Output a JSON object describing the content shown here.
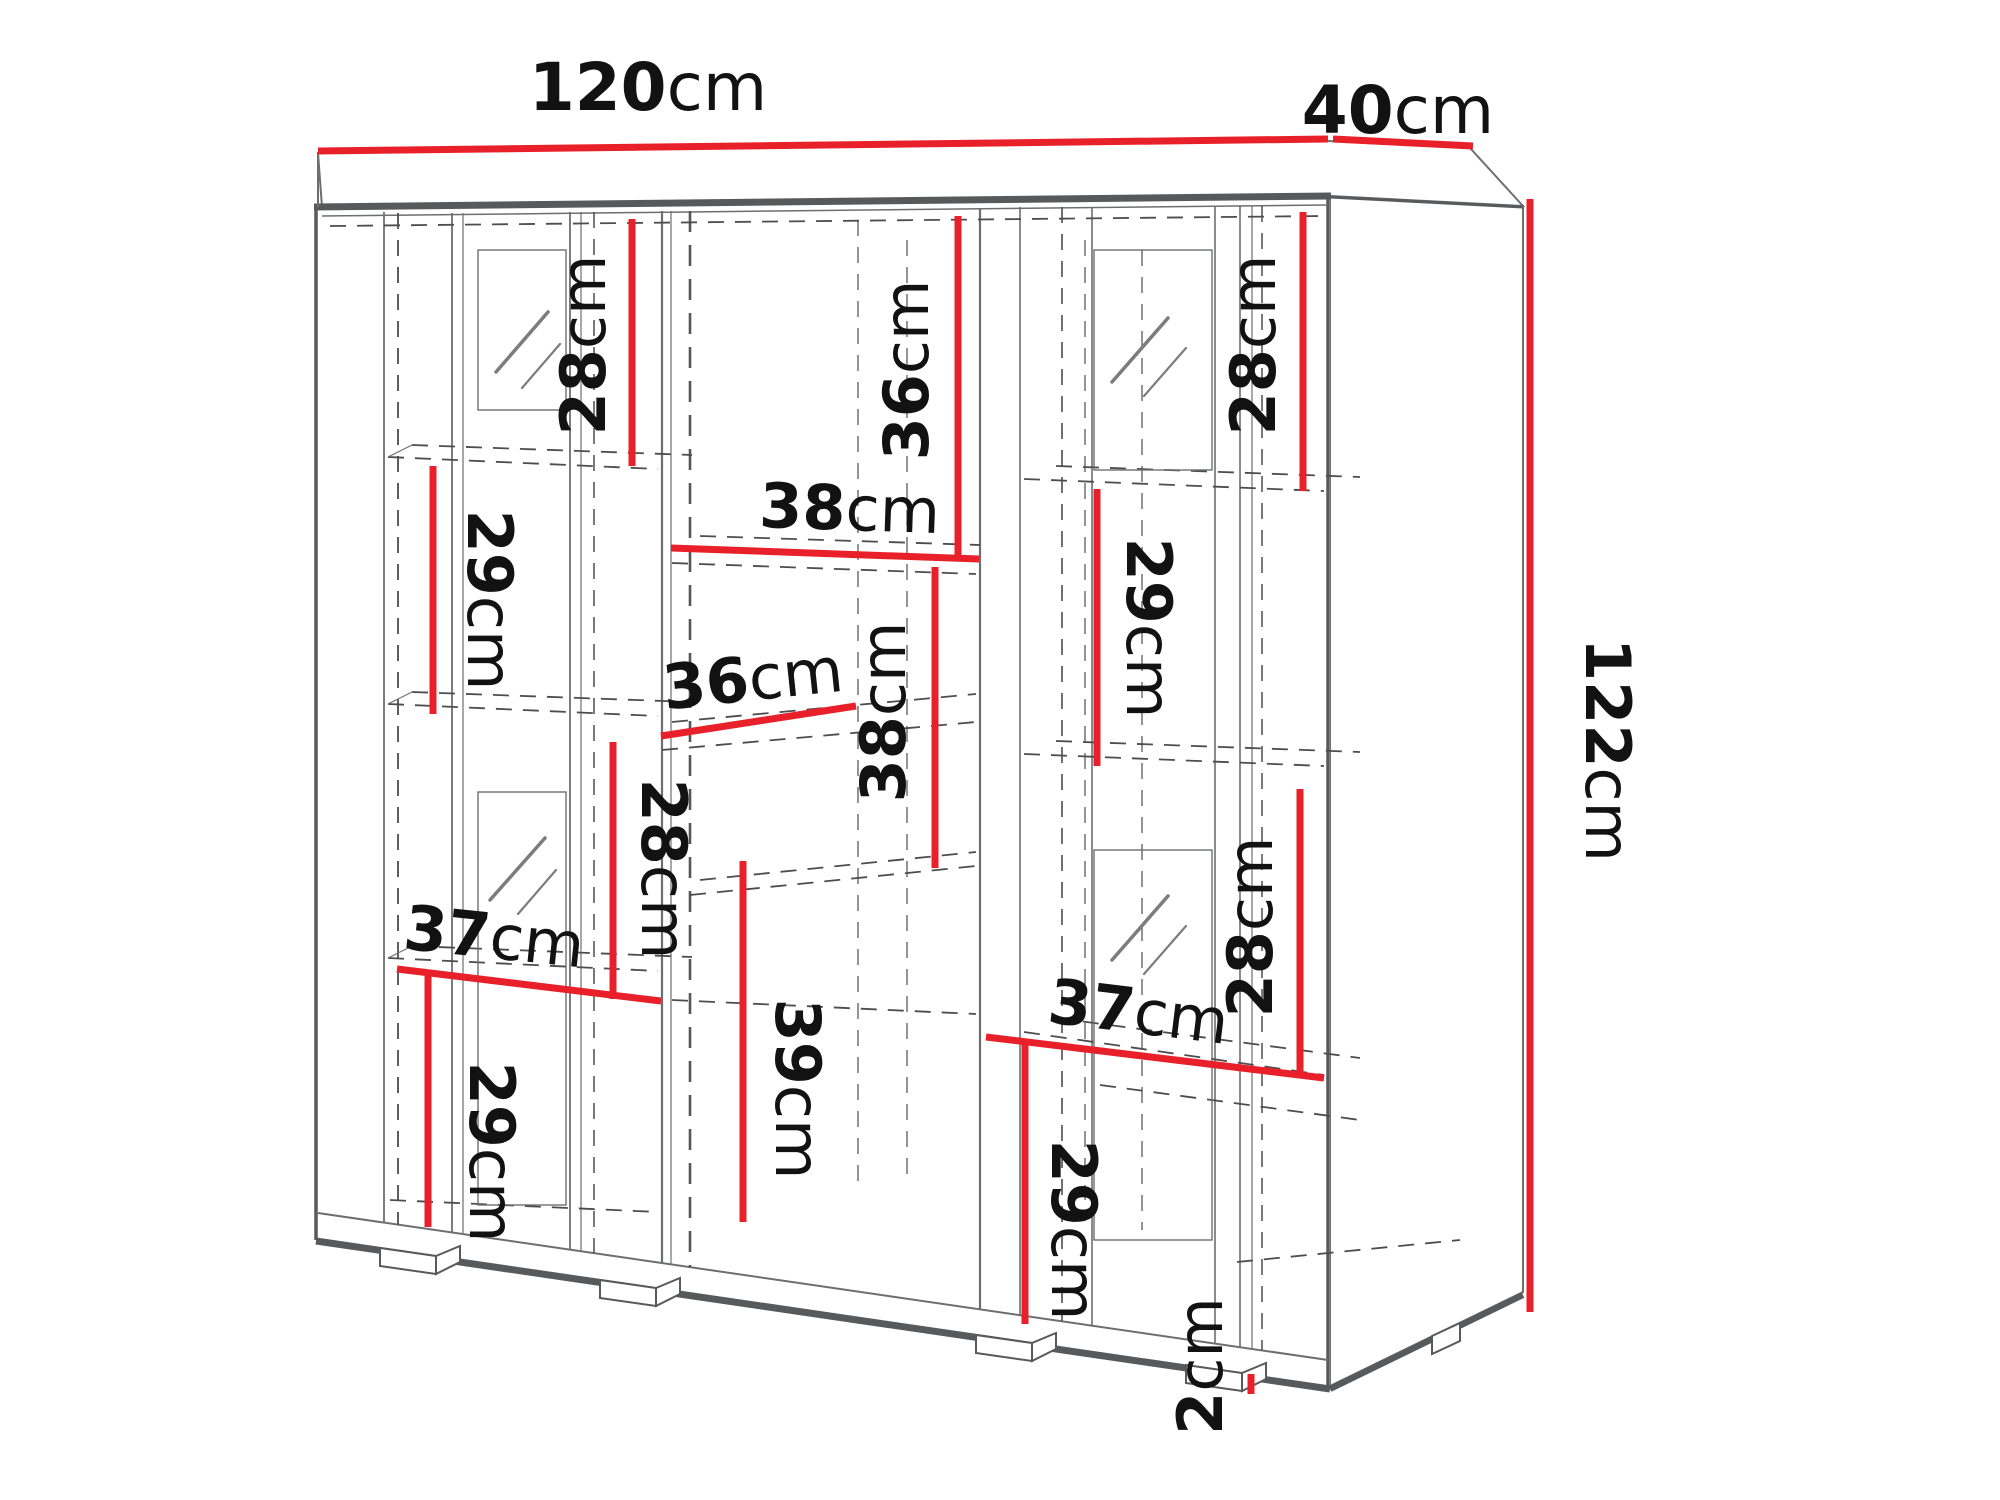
{
  "diagram": {
    "type": "furniture-dimension-drawing",
    "subject": "display cabinet with glass doors, shelves and feet",
    "unit": "cm",
    "colors": {
      "dimension_line": "#e8202a",
      "outline_dark": "#58595b",
      "outline_mid": "#6d6e71",
      "dashed_line": "#4d4d4d",
      "label_text": "#121212",
      "background": "#ffffff"
    },
    "dimensions": {
      "width": {
        "value": "120",
        "unit": "cm"
      },
      "depth": {
        "value": "40",
        "unit": "cm"
      },
      "height": {
        "value": "122",
        "unit": "cm"
      },
      "top_left_28": {
        "value": "28",
        "unit": "cm"
      },
      "top_middle_36": {
        "value": "36",
        "unit": "cm"
      },
      "top_right_28": {
        "value": "28",
        "unit": "cm"
      },
      "shelf_width_38": {
        "value": "38",
        "unit": "cm"
      },
      "left_29": {
        "value": "29",
        "unit": "cm"
      },
      "right_29": {
        "value": "29",
        "unit": "cm"
      },
      "shelf_width_36": {
        "value": "36",
        "unit": "cm"
      },
      "middle_38": {
        "value": "38",
        "unit": "cm"
      },
      "middle_left_28": {
        "value": "28",
        "unit": "cm"
      },
      "left_width_37": {
        "value": "37",
        "unit": "cm"
      },
      "bottom_left_29": {
        "value": "29",
        "unit": "cm"
      },
      "middle_39": {
        "value": "39",
        "unit": "cm"
      },
      "right_width_37": {
        "value": "37",
        "unit": "cm"
      },
      "bottom_right_29": {
        "value": "29",
        "unit": "cm"
      },
      "lower_right_28": {
        "value": "28",
        "unit": "cm"
      },
      "plinth_2": {
        "value": "2",
        "unit": "cm"
      }
    }
  }
}
